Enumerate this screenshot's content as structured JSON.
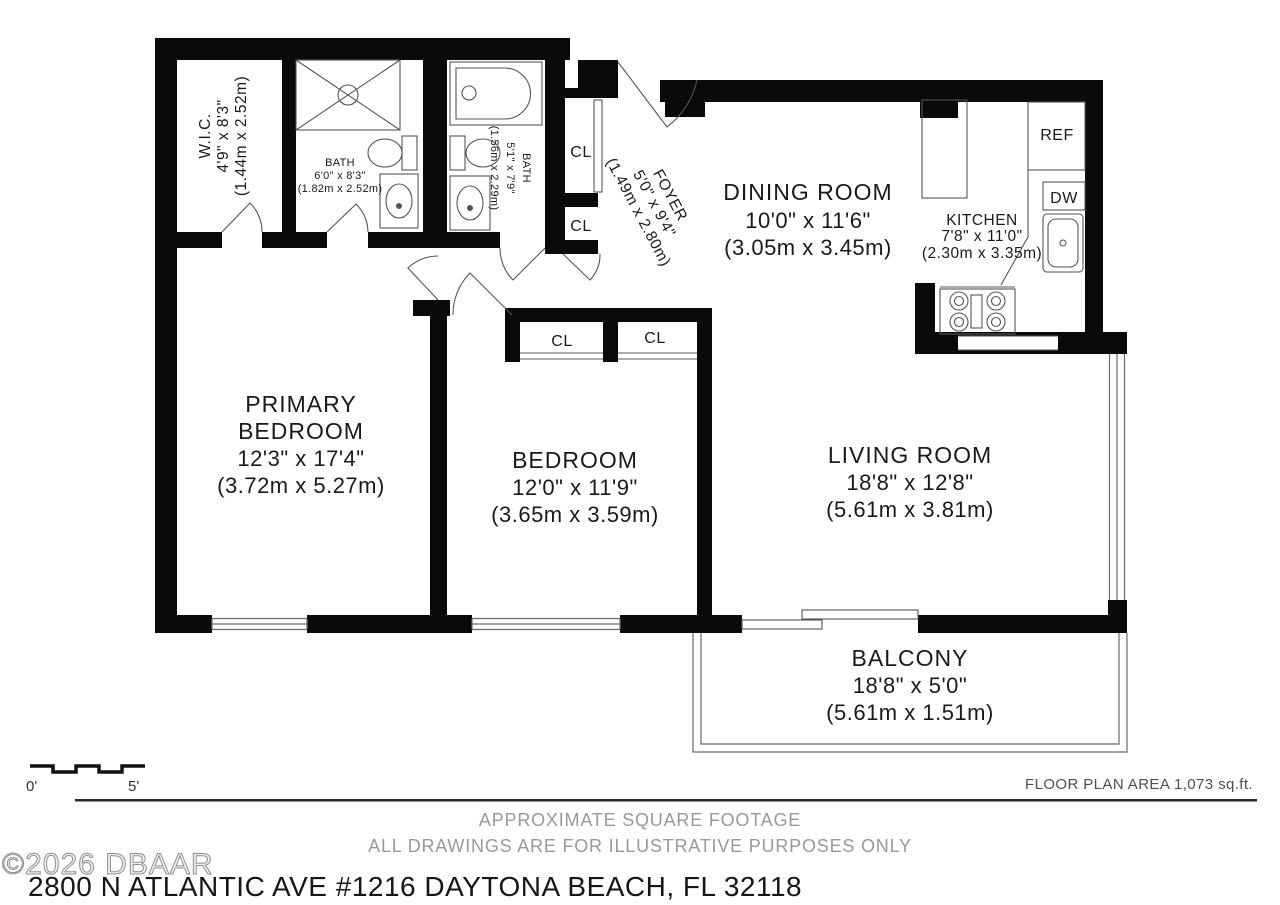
{
  "plan": {
    "rooms": {
      "wic": {
        "name": "W.I.C.",
        "dims": "4'9\" x 8'3\"",
        "metric": "(1.44m x 2.52m)"
      },
      "bath1": {
        "name": "BATH",
        "dims": "6'0\" x 8'3\"",
        "metric": "(1.82m x 2.52m)"
      },
      "bath2": {
        "name": "BATH",
        "dims": "5'1\" x 7'9\"",
        "metric": "(1.56m x 2.29m)"
      },
      "foyer": {
        "name": "FOYER",
        "dims": "5'0\" x 9'4\"",
        "metric": "(1.49m x 2.80m)"
      },
      "dining": {
        "name": "DINING ROOM",
        "dims": "10'0\" x 11'6\"",
        "metric": "(3.05m x 3.45m)"
      },
      "kitchen": {
        "name": "KITCHEN",
        "dims": "7'8\" x 11'0\"",
        "metric": "(2.30m x 3.35m)"
      },
      "primary": {
        "name_line1": "PRIMARY",
        "name_line2": "BEDROOM",
        "dims": "12'3\" x 17'4\"",
        "metric": "(3.72m x 5.27m)"
      },
      "bedroom": {
        "name": "BEDROOM",
        "dims": "12'0\" x 11'9\"",
        "metric": "(3.65m x 3.59m)"
      },
      "living": {
        "name": "LIVING ROOM",
        "dims": "18'8\" x 12'8\"",
        "metric": "(5.61m x 3.81m)"
      },
      "balcony": {
        "name": "BALCONY",
        "dims": "18'8\" x 5'0\"",
        "metric": "(5.61m x 1.51m)"
      }
    },
    "labels": {
      "closet": "CL",
      "refrigerator": "REF",
      "dishwasher": "DW"
    },
    "scale": {
      "start": "0'",
      "end": "5'"
    }
  },
  "footer": {
    "floor_plan_area": "FLOOR PLAN AREA 1,073 sq.ft.",
    "disclaimer_line1": "APPROXIMATE SQUARE FOOTAGE",
    "disclaimer_line2": "ALL DRAWINGS ARE FOR ILLUSTRATIVE PURPOSES ONLY",
    "watermark": "©2026 DBAAR",
    "address": "2800 N ATLANTIC AVE #1216 DAYTONA BEACH, FL 32118"
  },
  "colors": {
    "wall": "#0a0a0a",
    "fixture_line": "#555555",
    "window_line": "#6b6b6b",
    "label_text": "#1a1a1a",
    "muted_text": "#999999",
    "area_text": "#4f4f4f"
  }
}
